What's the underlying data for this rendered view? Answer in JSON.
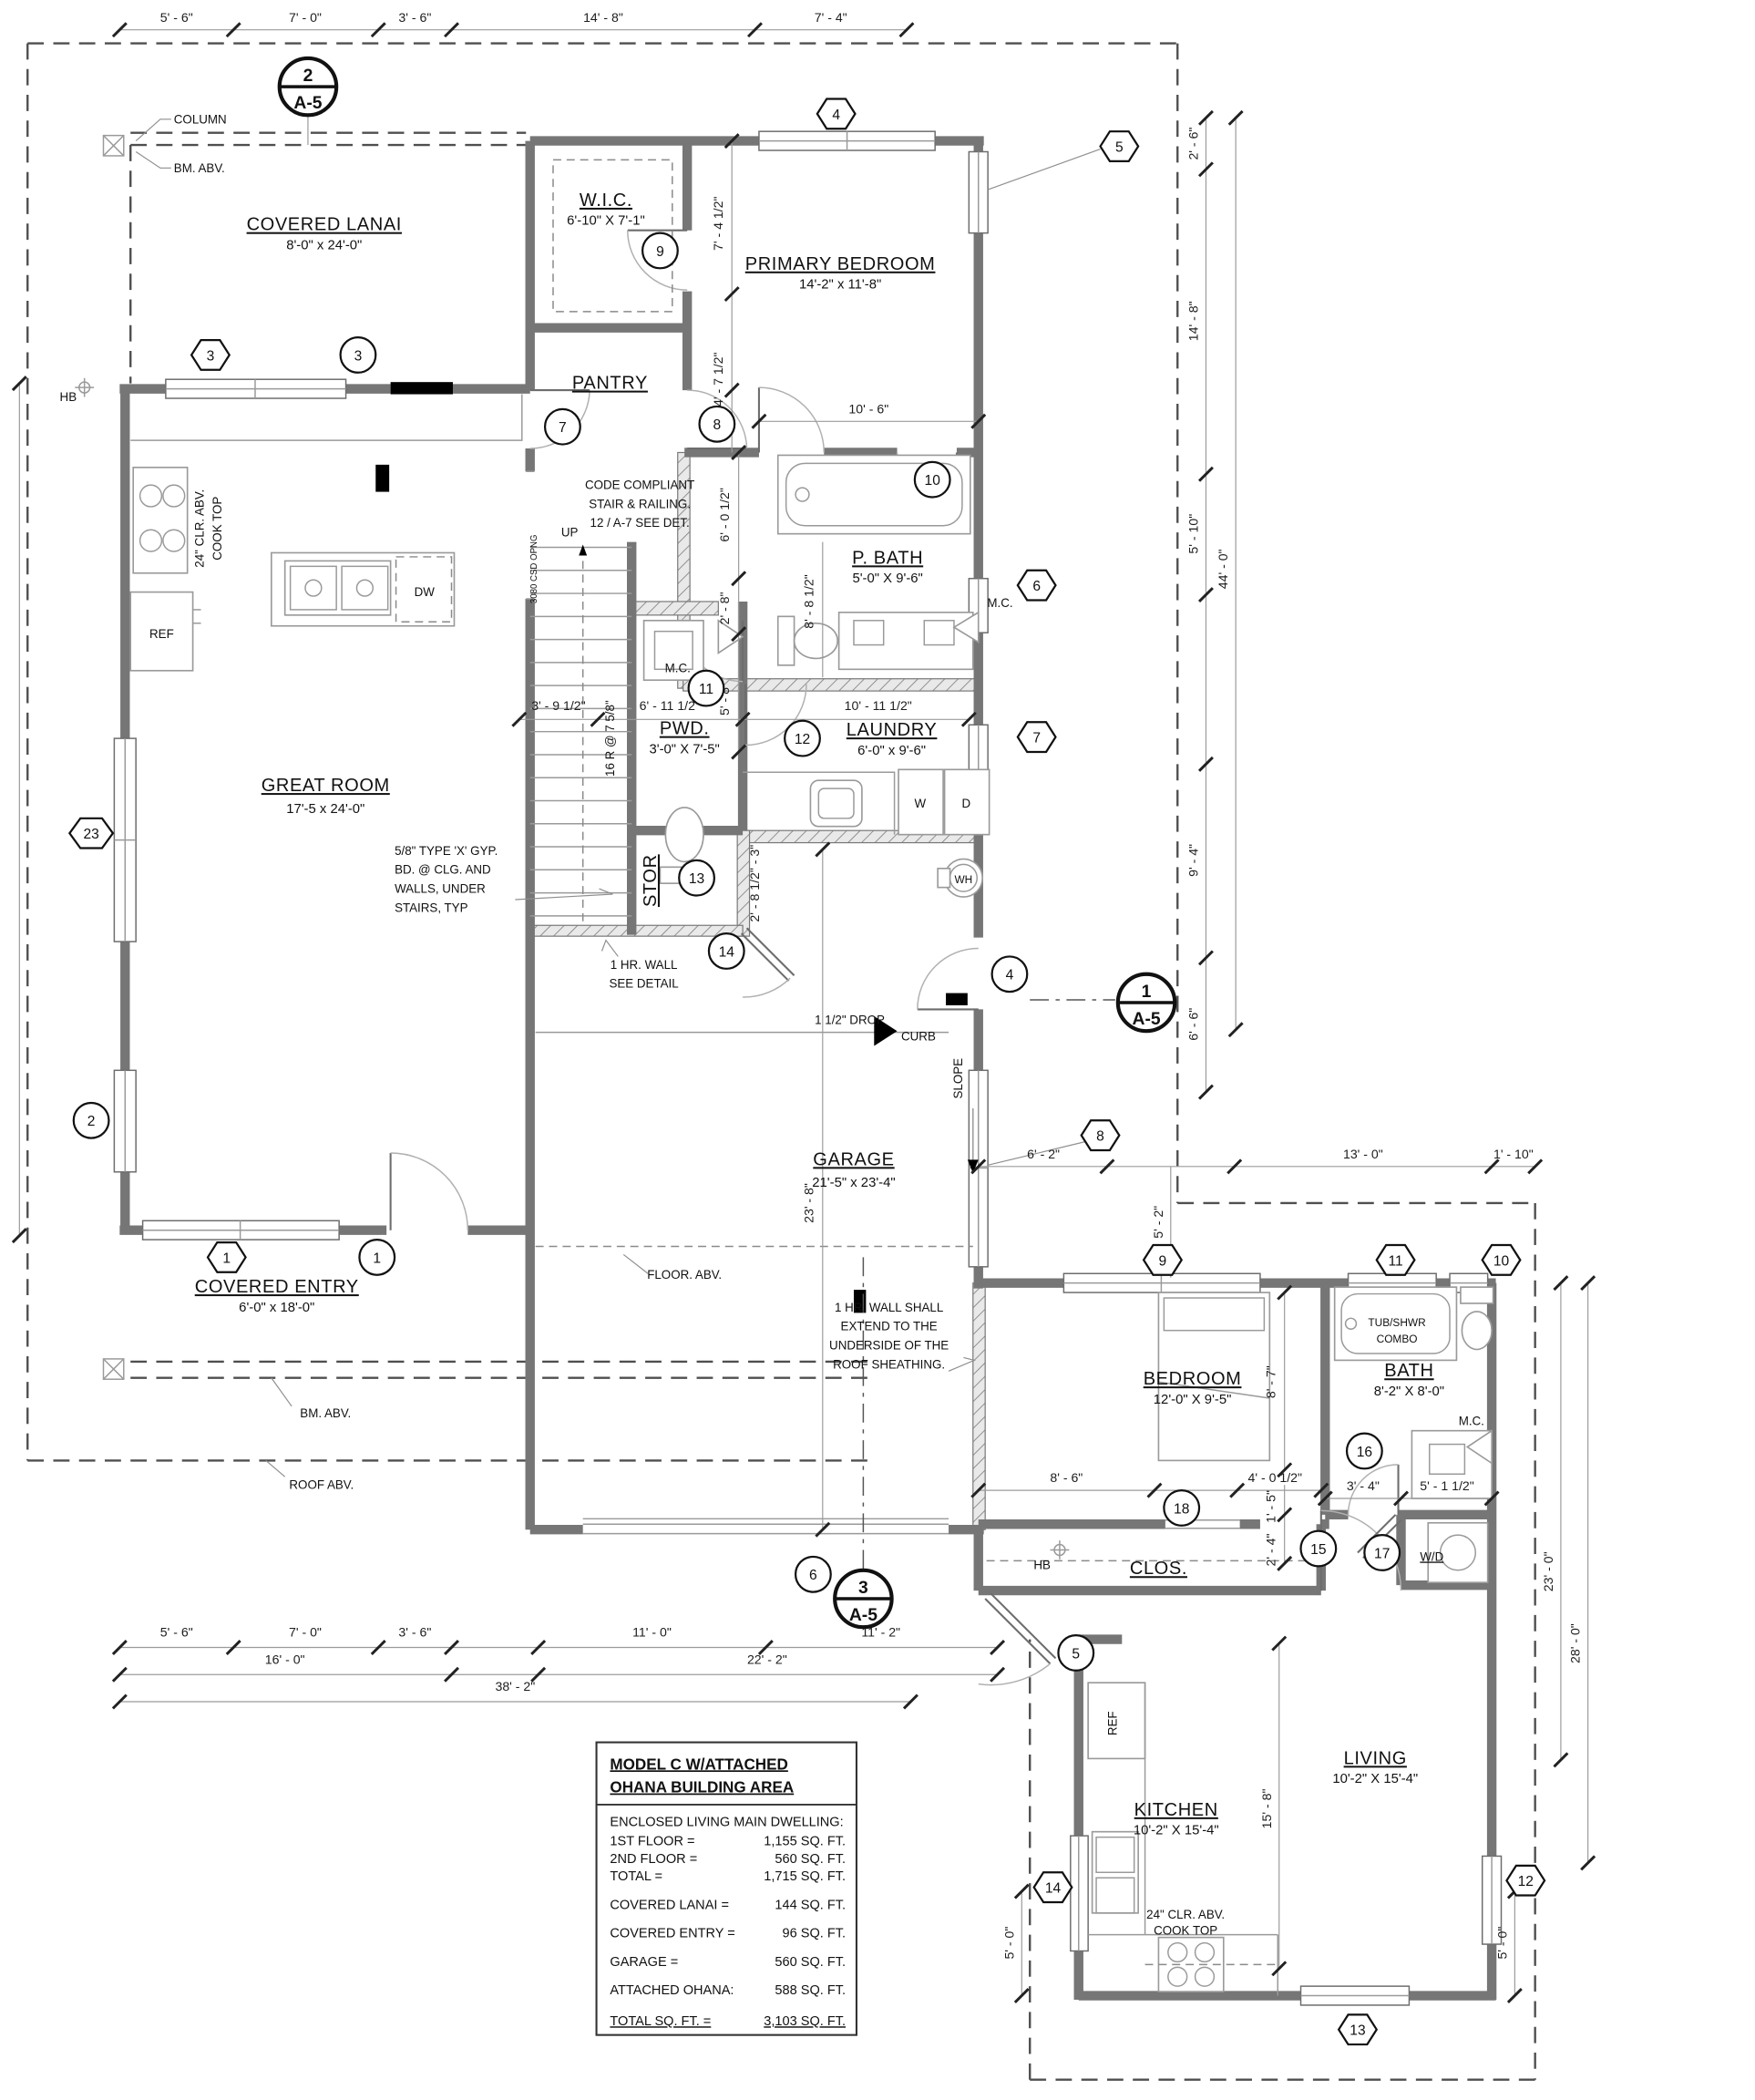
{
  "rooms": {
    "covered_lanai": {
      "name": "COVERED LANAI",
      "size": "8'-0\" x 24'-0\""
    },
    "wic": {
      "name": "W.I.C.",
      "size": "6'-10\" X 7'-1\""
    },
    "primary_bedroom": {
      "name": "PRIMARY BEDROOM",
      "size": "14'-2\" x 11'-8\""
    },
    "pantry": {
      "name": "PANTRY"
    },
    "p_bath": {
      "name": "P. BATH",
      "size": "5'-0\" X 9'-6\""
    },
    "laundry": {
      "name": "LAUNDRY",
      "size": "6'-0\" x 9'-6\""
    },
    "pwd": {
      "name": "PWD.",
      "size": "3'-0\" X 7'-5\""
    },
    "stor": {
      "name": "STOR"
    },
    "great_room": {
      "name": "GREAT ROOM",
      "size": "17'-5 x 24'-0\""
    },
    "garage": {
      "name": "GARAGE",
      "size": "21'-5\" x 23'-4\""
    },
    "covered_entry": {
      "name": "COVERED ENTRY",
      "size": "6'-0\" x 18'-0\""
    },
    "bedroom": {
      "name": "BEDROOM",
      "size": "12'-0\" X 9'-5\""
    },
    "bath": {
      "name": "BATH",
      "size": "8'-2\" X 8'-0\""
    },
    "clos": {
      "name": "CLOS."
    },
    "kitchen": {
      "name": "KITCHEN",
      "size": "10'-2\" X 15'-4\""
    },
    "living": {
      "name": "LIVING",
      "size": "10'-2\" X 15'-4\""
    }
  },
  "annotations": {
    "column": "COLUMN",
    "bm_abv": "BM. ABV.",
    "roof_abv": "ROOF ABV.",
    "hb": "HB",
    "up": "UP",
    "risers": "16 R @ 7 5/8\"",
    "csd": "3080 CSD OPNG",
    "code1": "CODE COMPLIANT",
    "code2": "STAIR & RAILING.",
    "code3": "12 / A-7    SEE DET.",
    "gyp1": "5/8\" TYPE 'X' GYP.",
    "gyp2": "BD. @ CLG. AND",
    "gyp3": "WALLS, UNDER",
    "gyp4": "STAIRS, TYP",
    "hr1": "1 HR. WALL",
    "hr2": "SEE DETAIL",
    "hrx1": "1 HR. WALL SHALL",
    "hrx2": "EXTEND TO THE",
    "hrx3": "UNDERSIDE OF THE",
    "hrx4": "ROOF SHEATHING.",
    "drop": "1 1/2\" DROP",
    "curb": "CURB",
    "slope": "SLOPE",
    "floor_abv": "FLOOR. ABV.",
    "clr1": "24\" CLR. ABV.",
    "clr2": "COOK TOP",
    "ref": "REF",
    "dw": "DW",
    "w": "W",
    "d": "D",
    "wh": "WH",
    "mc": "M.C.",
    "wd": "W/D",
    "tub1": "TUB/SHWR",
    "tub2": "COMBO"
  },
  "dims": {
    "d5_6": "5' - 6\"",
    "d7_0": "7' - 0\"",
    "d3_6": "3' - 6\"",
    "d14_8": "14' - 8\"",
    "d7_4": "7' - 4\"",
    "d2_6": "2' - 6\"",
    "d5_10": "5' - 10\"",
    "d44_0": "44' - 0\"",
    "d9_4": "9' - 4\"",
    "d6_6": "6' - 6\"",
    "d6_2": "6' - 2\"",
    "d5_2": "5' - 2\"",
    "d13_0": "13' - 0\"",
    "d1_10": "1' - 10\"",
    "d23_0": "23' - 0\"",
    "d28_0": "28' - 0\"",
    "d5_0": "5' - 0\"",
    "d11_0": "11' - 0\"",
    "d11_2": "11' - 2\"",
    "d16_0": "16' - 0\"",
    "d22_2": "22' - 2\"",
    "d38_2": "38' - 2\"",
    "d7_4h": "7' - 4 1/2\"",
    "d4_7h": "4' - 7 1/2\"",
    "d10_6": "10' - 6\"",
    "d8_8h": "8' - 8 1/2\"",
    "d6_0h": "6' - 0 1/2\"",
    "d2_8": "2' - 8\"",
    "d10_11h": "10' - 11 1/2\"",
    "d5_8": "5' - 8\"",
    "d6_11h": "6' - 11 1/2\"",
    "d3_9h": "3' - 9 1/2\"",
    "d2_8h3": "2' - 8 1/2\" - 3\"",
    "d23_8": "23' - 8\"",
    "d8_6": "8' - 6\"",
    "d8_7": "8' - 7\"",
    "d4_0h": "4' - 0 1/2\"",
    "d3_4": "3' - 4\"",
    "d5_1h": "5' - 1 1/2\"",
    "d1_5": "1' - 5\"",
    "d2_4": "2' - 4\"",
    "d15_8": "15' - 8\""
  },
  "tags": {
    "c1": "1",
    "c2": "2",
    "c3": "3",
    "c4": "4",
    "c5": "5",
    "c6": "6",
    "c7": "7",
    "c8": "8",
    "c9": "9",
    "c10": "10",
    "c11": "11",
    "c12": "12",
    "c13": "13",
    "c14": "14",
    "c15": "15",
    "c16": "16",
    "c17": "17",
    "c18": "18",
    "h1": "1",
    "h3": "3",
    "h4": "4",
    "h5": "5",
    "h6": "6",
    "h7": "7",
    "h8": "8",
    "h9": "9",
    "h10": "10",
    "h11": "11",
    "h12": "12",
    "h13": "13",
    "h14": "14",
    "h23": "23"
  },
  "sections": {
    "s1": {
      "num": "1",
      "sheet": "A-5"
    },
    "s2": {
      "num": "2",
      "sheet": "A-5"
    },
    "s3": {
      "num": "3",
      "sheet": "A-5"
    }
  },
  "area_table": {
    "title1": "MODEL C W/ATTACHED",
    "title2": "OHANA BUILDING AREA",
    "header": "ENCLOSED LIVING MAIN DWELLING:",
    "rows": [
      {
        "label": "1ST FLOOR =",
        "value": "1,155 SQ. FT."
      },
      {
        "label": "2ND FLOOR =",
        "value": "560 SQ. FT."
      },
      {
        "label": "TOTAL =",
        "value": "1,715 SQ. FT."
      },
      {
        "label": "COVERED LANAI =",
        "value": "144 SQ. FT."
      },
      {
        "label": "COVERED ENTRY =",
        "value": "96 SQ. FT."
      },
      {
        "label": "GARAGE =",
        "value": "560 SQ. FT."
      },
      {
        "label": "ATTACHED OHANA:",
        "value": "588 SQ. FT."
      },
      {
        "label": "TOTAL SQ. FT. =",
        "value": "3,103 SQ. FT."
      }
    ]
  }
}
